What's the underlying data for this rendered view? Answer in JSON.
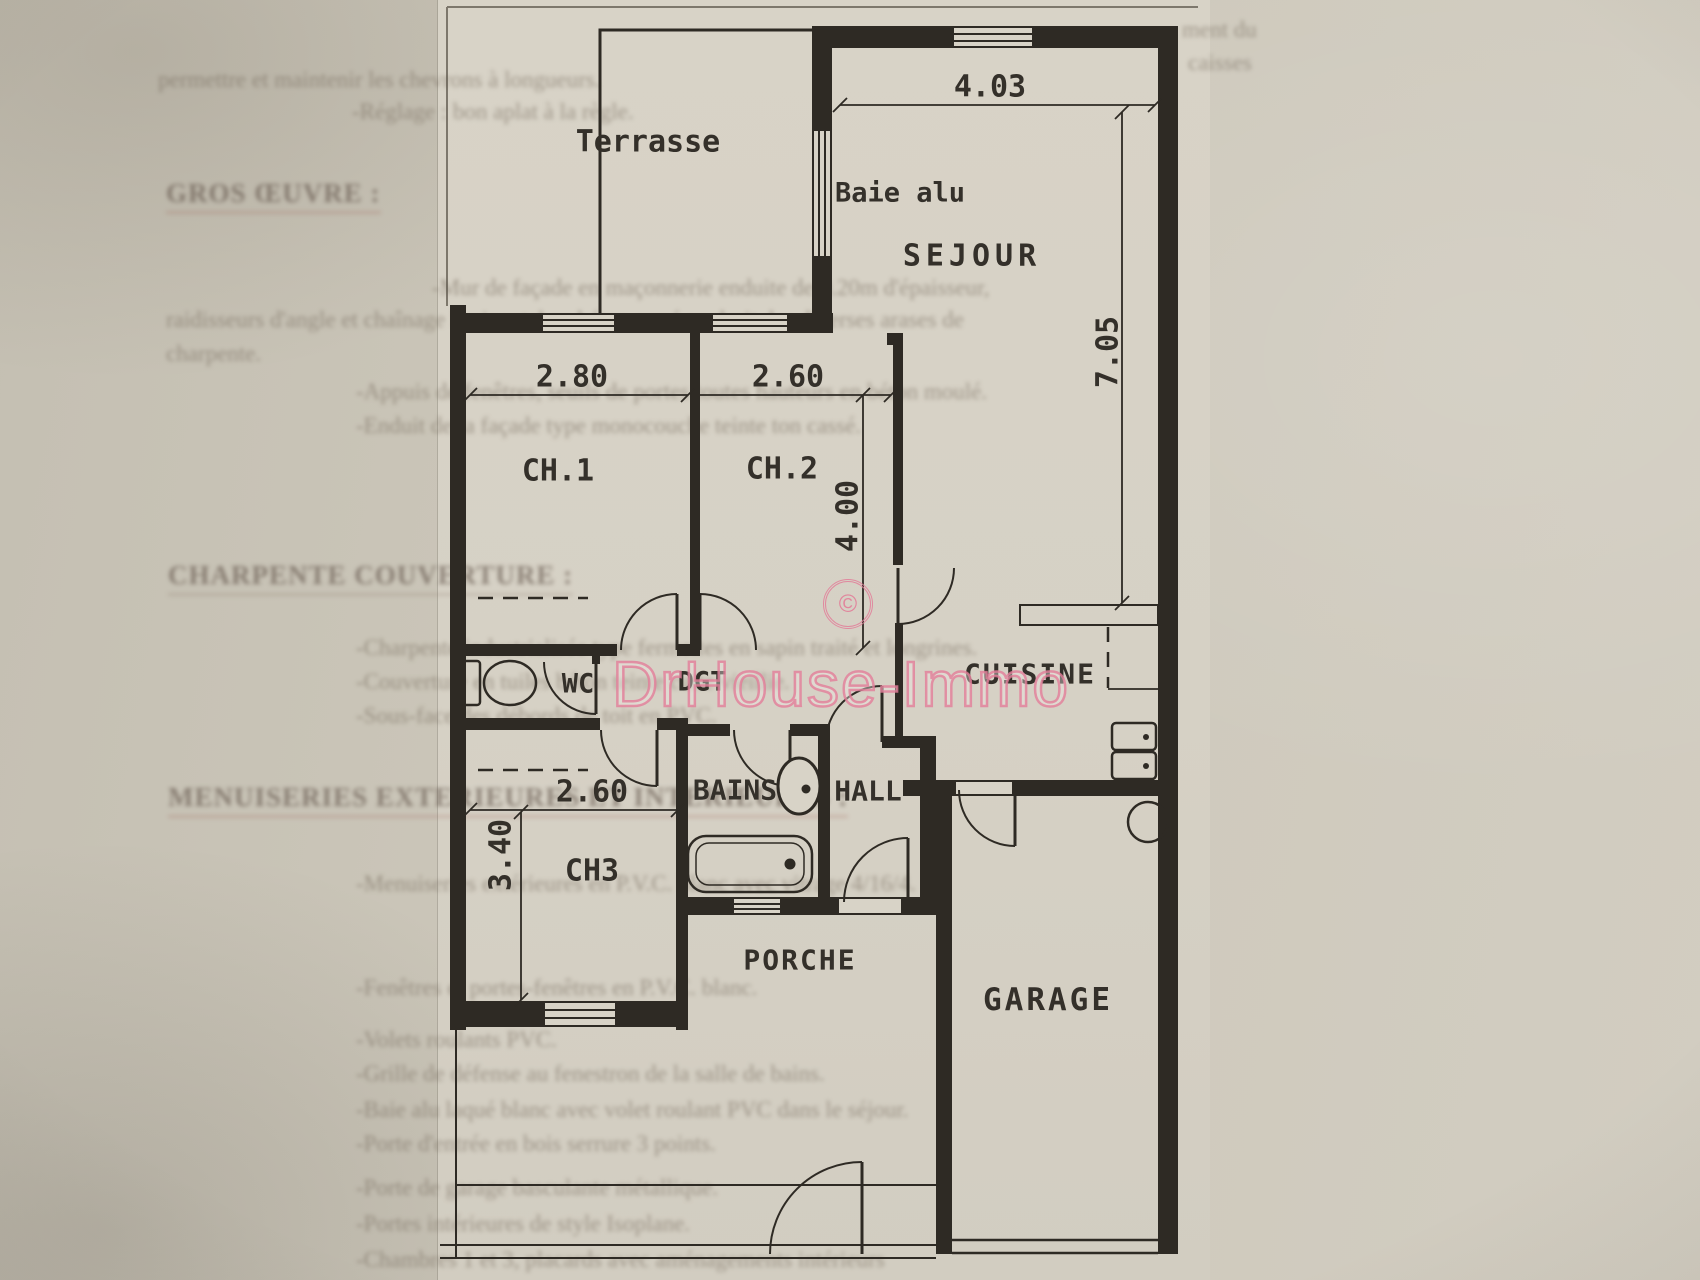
{
  "page": {
    "width": 1700,
    "height": 1280,
    "description": "Scanned page with house floor plan"
  },
  "colors": {
    "ink": "#2e2a24",
    "paper_sheet": "#d6d1c5",
    "page_background": "#cbc6b9",
    "watermark_pink": "#e27d98",
    "ghost_text": "#6b5f51"
  },
  "watermark": {
    "copyright_symbol": "©",
    "brand": "DrHouse-Immo"
  },
  "plan": {
    "room_labels": [
      {
        "id": "terrasse",
        "label": "Terrasse",
        "x": 648,
        "y": 142,
        "size": 30
      },
      {
        "id": "baie-alu",
        "label": "Baie alu",
        "x": 900,
        "y": 193,
        "size": 27
      },
      {
        "id": "sejour",
        "label": "SEJOUR",
        "x": 972,
        "y": 256,
        "size": 30,
        "ls": 5
      },
      {
        "id": "ch1",
        "label": "CH.1",
        "x": 558,
        "y": 471,
        "size": 30
      },
      {
        "id": "ch2",
        "label": "CH.2",
        "x": 782,
        "y": 469,
        "size": 30
      },
      {
        "id": "wc",
        "label": "WC",
        "x": 578,
        "y": 684,
        "size": 27
      },
      {
        "id": "dgt",
        "label": "DGT",
        "x": 702,
        "y": 682,
        "size": 27
      },
      {
        "id": "bains",
        "label": "BAINS",
        "x": 735,
        "y": 790,
        "size": 28
      },
      {
        "id": "hall",
        "label": "HALL",
        "x": 868,
        "y": 791,
        "size": 28
      },
      {
        "id": "cuisine",
        "label": "CUISINE",
        "x": 1030,
        "y": 674,
        "size": 28,
        "ls": 2
      },
      {
        "id": "ch3",
        "label": "CH3",
        "x": 592,
        "y": 871,
        "size": 30
      },
      {
        "id": "porche",
        "label": "PORCHE",
        "x": 800,
        "y": 960,
        "size": 28,
        "ls": 2
      },
      {
        "id": "garage",
        "label": "GARAGE",
        "x": 1048,
        "y": 1000,
        "size": 31,
        "ls": 3
      }
    ],
    "dimensions": [
      {
        "id": "sejour-width",
        "label": "4.03",
        "x": 990,
        "y": 87,
        "size": 30
      },
      {
        "id": "sejour-height",
        "label": "7.05",
        "x": 1108,
        "y": 352,
        "size": 30,
        "rotate": -90
      },
      {
        "id": "ch1-width",
        "label": "2.80",
        "x": 572,
        "y": 377,
        "size": 30
      },
      {
        "id": "ch2-width",
        "label": "2.60",
        "x": 788,
        "y": 377,
        "size": 30
      },
      {
        "id": "ch2-height",
        "label": "4.00",
        "x": 848,
        "y": 516,
        "size": 30,
        "rotate": -90
      },
      {
        "id": "ch3-width",
        "label": "2.60",
        "x": 592,
        "y": 792,
        "size": 30
      },
      {
        "id": "ch3-height",
        "label": "3.40",
        "x": 501,
        "y": 855,
        "size": 30,
        "rotate": -90
      }
    ],
    "fixtures": [
      "toilet",
      "washbasin",
      "bathtub",
      "kitchen-counter",
      "kitchen-sink",
      "water-heater",
      "garage-door",
      "pedestrian-gate"
    ]
  },
  "ghost_text": {
    "note": "faint show-through print from reverse side of the page, barely legible",
    "headings": [
      {
        "text": "GROS ŒUVRE :",
        "x": 166,
        "y": 196,
        "underline": "#9a5a50"
      },
      {
        "text": "CHARPENTE COUVERTURE :",
        "x": 168,
        "y": 578,
        "underline": "#857465"
      },
      {
        "text": "MENUISERIES EXTERIEURES ET INTERIEURES :",
        "x": 168,
        "y": 800,
        "underline": "#9a5a50"
      }
    ],
    "lines": [
      {
        "text": "permettre et maintenir les chevrons à longueurs.",
        "x": 158,
        "y": 80
      },
      {
        "text": "-Réglage : bon aplat à la règle.",
        "x": 352,
        "y": 112
      },
      {
        "text": "-Mur de façade en maçonnerie enduite de 0.20m d'épaisseur,",
        "x": 432,
        "y": 288
      },
      {
        "text": "raidisseurs d'angle et chaînage horizontal en béton armé au droit des diverses arases de",
        "x": 166,
        "y": 320
      },
      {
        "text": "charpente.",
        "x": 166,
        "y": 354
      },
      {
        "text": "-Appuis de fenêtres, seuils de portes toutes hauteurs en béton moulé.",
        "x": 356,
        "y": 392
      },
      {
        "text": "-Enduit de la façade type monocouche teinte ton cassé.",
        "x": 356,
        "y": 426
      },
      {
        "text": "-Charpente industrialisée type fermettes en sapin traité et longrines.",
        "x": 356,
        "y": 648
      },
      {
        "text": "-Couverture en tuiles béton teinte cuite vieillie.",
        "x": 356,
        "y": 682
      },
      {
        "text": "-Sous-face des débords de toit en PVC.",
        "x": 356,
        "y": 716
      },
      {
        "text": "-Menuiseries extérieures en P.V.C. blanc avec vitrage 4/16/4.",
        "x": 356,
        "y": 884
      },
      {
        "text": "-Fenêtres et portes-fenêtres en P.V.C. blanc.",
        "x": 356,
        "y": 988
      },
      {
        "text": "-Volets roulants PVC.",
        "x": 356,
        "y": 1040
      },
      {
        "text": "-Grille de défense au fenestron de la salle de bains.",
        "x": 356,
        "y": 1074
      },
      {
        "text": "-Baie alu laqué blanc avec volet roulant PVC dans le séjour.",
        "x": 356,
        "y": 1110
      },
      {
        "text": "-Porte d'entrée en bois serrure 3 points.",
        "x": 356,
        "y": 1144
      },
      {
        "text": "-Porte de garage basculante métallique.",
        "x": 356,
        "y": 1188
      },
      {
        "text": "-Portes intérieures de style Isoplane.",
        "x": 356,
        "y": 1224
      },
      {
        "text": "-Chambres 1 et 3, placards avec aménagements intérieurs",
        "x": 356,
        "y": 1260
      }
    ],
    "fragments": [
      {
        "text": "ment du",
        "x": 1182,
        "y": 30
      },
      {
        "text": "caisses",
        "x": 1188,
        "y": 63
      }
    ]
  }
}
